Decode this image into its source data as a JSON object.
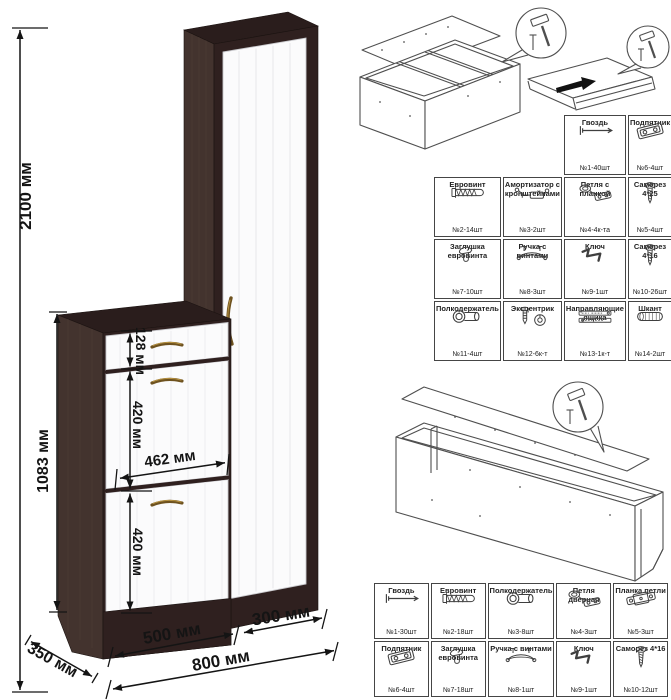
{
  "page": {
    "background": "#ffffff"
  },
  "colors": {
    "carcass_front": "#2f201f",
    "carcass_side": "#43332e",
    "carcass_top": "#2a1d1c",
    "front_white": "#fbfbfc",
    "groove": "#ececef",
    "handle_bronze": "#6e521f",
    "handle_highlight": "#c9a24b",
    "dimension_line": "#141414",
    "diagram_line": "#4f4f4f",
    "table_border": "#454545"
  },
  "dimensions": {
    "total_height": "2100 мм",
    "lower_height": "1083 мм",
    "drawer_height": "128 мм",
    "flap1_height": "420 мм",
    "inner_width": "462 мм",
    "flap2_height": "420 мм",
    "lower_width": "500 мм",
    "column_width": "300 мм",
    "total_width": "800 мм",
    "depth": "350 мм"
  },
  "assembly_diagrams": [
    {
      "icon": "hammer-icon",
      "name": "nailing-back-panel-to-cabinet-box"
    },
    {
      "icon": "hammer-icon",
      "name": "nailing-bottom-to-drawer"
    },
    {
      "icon": "hammer-icon",
      "name": "nailing-back-panel-to-tall-column"
    }
  ],
  "upper_parts": {
    "cells": [
      {
        "name": "Гвоздь",
        "count": "№1-40шт",
        "icon": "nail-icon"
      },
      {
        "name": "Подпятник",
        "count": "№6-4шт",
        "icon": "glide-icon"
      },
      {
        "name": "Евровинт",
        "count": "№2-14шт",
        "icon": "euroscrew-icon"
      },
      {
        "name": "Амортизатор с кронштейнами",
        "count": "№3-2шт",
        "icon": "gas-strut-icon"
      },
      {
        "name": "Петля с планкой",
        "count": "№4-4к-та",
        "icon": "hinge-icon"
      },
      {
        "name": "Саморез 4*25",
        "count": "№5-4шт",
        "icon": "screw-icon"
      },
      {
        "name": "Заглушка евровинта",
        "count": "№7-10шт",
        "icon": "cap-icon"
      },
      {
        "name": "Ручка с винтами",
        "count": "№8-3шт",
        "icon": "handle-icon"
      },
      {
        "name": "Ключ",
        "count": "№9-1шт",
        "icon": "hex-key-icon"
      },
      {
        "name": "Саморез 4*16",
        "count": "№10-26шт",
        "icon": "screw-icon"
      },
      {
        "name": "Полкодержатель",
        "count": "№11-4шт",
        "icon": "shelf-pin-icon"
      },
      {
        "name": "Эксцентрик",
        "count": "№12-6к-т",
        "icon": "cam-icon"
      },
      {
        "name": "Направляющие ящика",
        "count": "№13-1к-т",
        "icon": "slides-icon"
      },
      {
        "name": "Шкант",
        "count": "№14-2шт",
        "icon": "dowel-icon"
      }
    ]
  },
  "lower_parts": {
    "cells": [
      {
        "name": "Гвоздь",
        "count": "№1-30шт",
        "icon": "nail-icon"
      },
      {
        "name": "Евровинт",
        "count": "№2-18шт",
        "icon": "euroscrew-icon"
      },
      {
        "name": "Полкодержатель",
        "count": "№3-8шт",
        "icon": "shelf-pin-icon"
      },
      {
        "name": "Петля дверная",
        "count": "№4-3шт",
        "icon": "hinge-icon"
      },
      {
        "name": "Планка петли",
        "count": "№5-3шт",
        "icon": "hinge-plate-icon"
      },
      {
        "name": "Подпятник",
        "count": "№6-4шт",
        "icon": "glide-icon"
      },
      {
        "name": "Заглушка евровинта",
        "count": "№7-18шт",
        "icon": "cap-icon"
      },
      {
        "name": "Ручка с винтами",
        "count": "№8-1шт",
        "icon": "handle-icon"
      },
      {
        "name": "Ключ",
        "count": "№9-1шт",
        "icon": "hex-key-icon"
      },
      {
        "name": "Саморез 4*16",
        "count": "№10-12шт",
        "icon": "screw-icon"
      }
    ]
  }
}
